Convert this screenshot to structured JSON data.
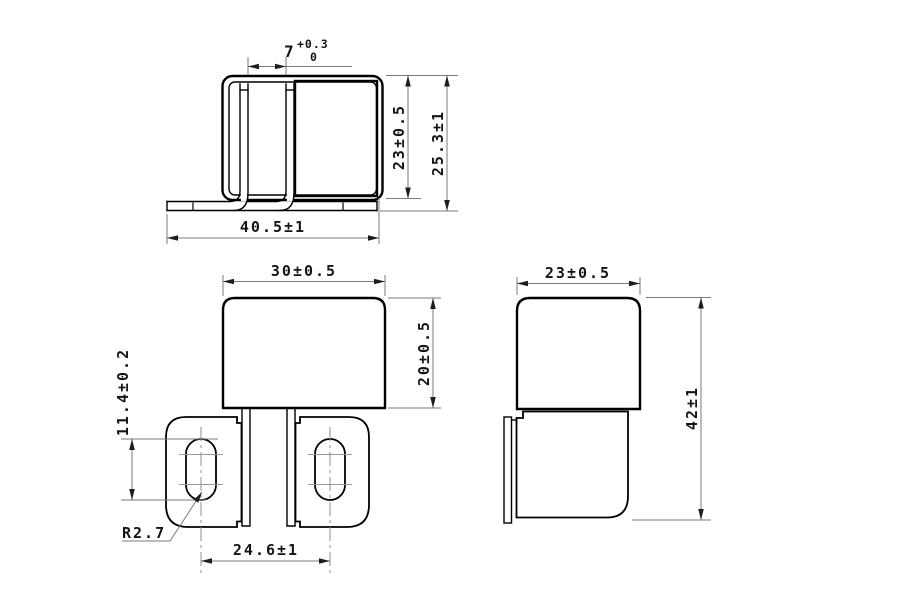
{
  "drawing": {
    "background": "#ffffff",
    "line_color": "#000000",
    "dim_line_color": "#7a7a7a",
    "view_side_profile": {
      "pin_gap": {
        "value": "7",
        "tol_upper": "+0.3",
        "tol_lower": "0"
      },
      "case_height": "23±0.5",
      "overall_height": "25.3±1",
      "base_width": "40.5±1"
    },
    "view_front": {
      "body_width": "30±0.5",
      "body_height": "20±0.5",
      "slot_length": "11.4±0.2",
      "slot_radius": "R2.7",
      "hole_pitch": "24.6±1"
    },
    "view_right_side": {
      "body_width": "23±0.5",
      "overall_height": "42±1"
    }
  }
}
